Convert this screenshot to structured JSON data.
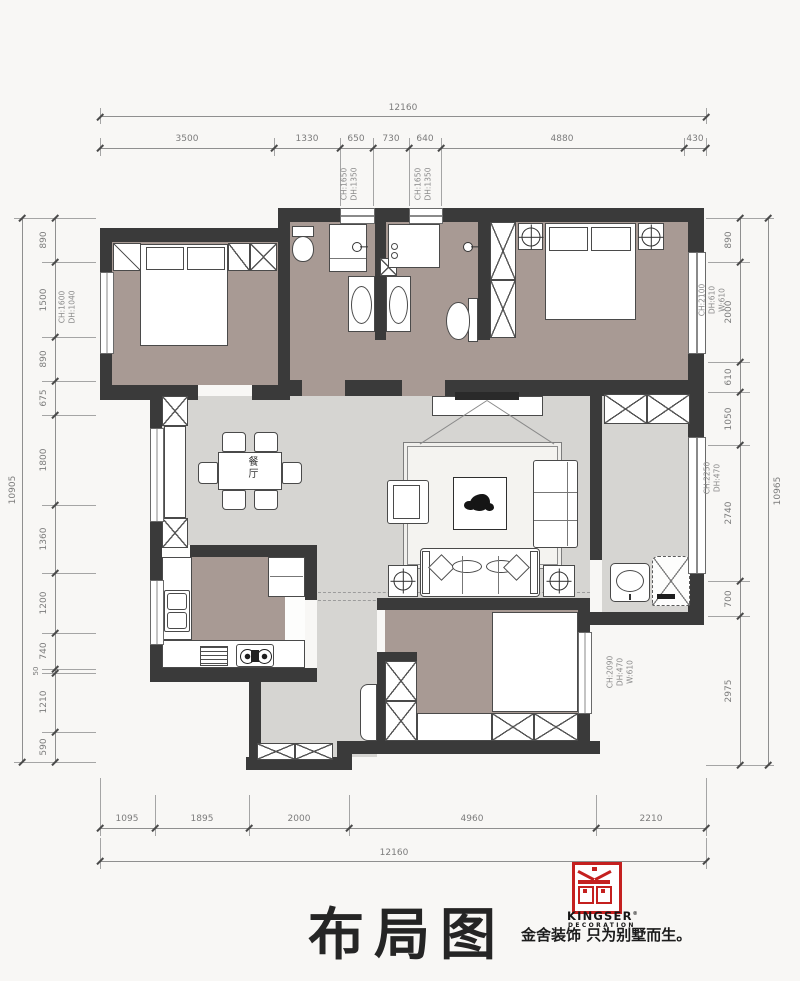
{
  "drawing": {
    "title": "布局图"
  },
  "rooms": {
    "dining_label": "餐厅"
  },
  "logo": {
    "glyph": "jin-seal",
    "brand": "KINGSER",
    "trademark": "®",
    "division": "DECORATION",
    "tagline": "金舍装饰 只为别墅而生。"
  },
  "colors": {
    "wall": "#3a3a3a",
    "warm_floor": "#a89a94",
    "cool_floor": "#d6d5d2",
    "logo_red": "#c4201f"
  },
  "dimensions": {
    "top": {
      "total": "12160",
      "segments": [
        "3500",
        "1330",
        "650",
        "730",
        "640",
        "4880",
        "430"
      ]
    },
    "bottom": {
      "total": "12160",
      "segments": [
        "1095",
        "1895",
        "2000",
        "4960",
        "2210"
      ]
    },
    "left": {
      "total": "10905",
      "segments": [
        "890",
        "1500",
        "890",
        "675",
        "1800",
        "1360",
        "1200",
        "740",
        "50",
        "1210",
        "590"
      ]
    },
    "right": {
      "total": "10965",
      "segments": [
        "890",
        "2000",
        "610",
        "1050",
        "2740",
        "700",
        "2975"
      ]
    }
  },
  "annotations": {
    "top_window_left": [
      "CH:1650",
      "DH:1350"
    ],
    "top_window_right": [
      "CH:1650",
      "DH:1350"
    ],
    "left_window": [
      "CH:1600",
      "DH:1040"
    ],
    "right_window_top": [
      "CH:2100",
      "DH:610",
      "W:610"
    ],
    "right_window_mid": [
      "CH:2250",
      "DH:470"
    ],
    "bottom_right_window": [
      "CH:2090",
      "DH:470",
      "W:610"
    ]
  }
}
